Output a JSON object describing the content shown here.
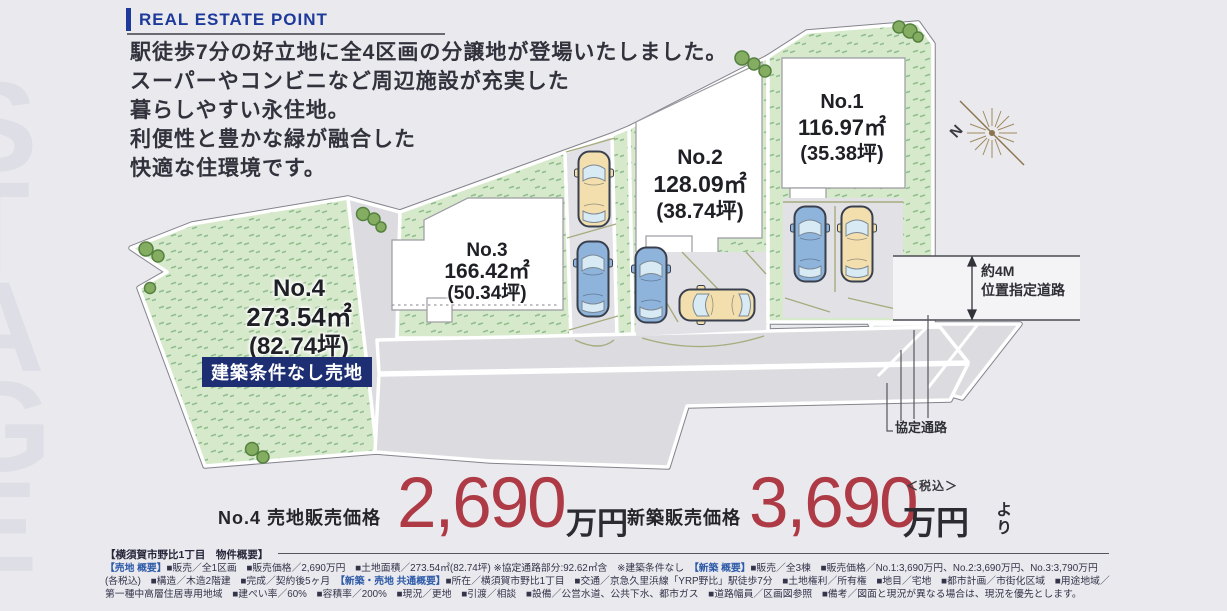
{
  "header": {
    "title": "REAL ESTATE POINT"
  },
  "intro": {
    "line1": "駅徒歩7分の好立地に全4区画の分譲地が登場いたしました。",
    "line2": "スーパーやコンビニなど周辺施設が充実した",
    "line3": "暮らしやすい永住地。",
    "line4": "利便性と豊かな緑が融合した",
    "line5": "快適な住環境です。"
  },
  "watermark": {
    "letters": "STAGE"
  },
  "plots": [
    {
      "id": "No.1",
      "area_sqm": "116.97㎡",
      "area_tsubo": "(35.38坪)"
    },
    {
      "id": "No.2",
      "area_sqm": "128.09㎡",
      "area_tsubo": "(38.74坪)"
    },
    {
      "id": "No.3",
      "area_sqm": "166.42㎡",
      "area_tsubo": "(50.34坪)"
    },
    {
      "id": "No.4",
      "area_sqm": "273.54㎡",
      "area_tsubo": "(82.74坪)",
      "badge": "建築条件なし売地"
    }
  ],
  "map_labels": {
    "road_width": "約4M",
    "road_type": "位置指定道路",
    "passage": "協定通路",
    "compass_north": "N"
  },
  "prices": {
    "land": {
      "label": "No.4 売地販売価格",
      "amount": "2,690",
      "unit": "万円"
    },
    "new_build": {
      "label": "新築販売価格",
      "amount": "3,690",
      "unit": "万円",
      "tax_note": "＜税込＞",
      "suffix": "より"
    }
  },
  "outline": {
    "title": "【横須賀市野比1丁目　物件概要】",
    "line1": [
      {
        "t": "【売地 概要】",
        "c": "blue"
      },
      {
        "t": "■販売／全1区画　■販売価格／2,690万円　■土地面積／273.54㎡(82.74坪) ※協定通路部分:92.62㎡含　※建築条件なし　",
        "c": "n"
      },
      {
        "t": "【新築 概要】",
        "c": "blue"
      },
      {
        "t": "■販売／全3棟　■販売価格／No.1:3,690万円、No.2:3,690万円、No.3:3,790万円",
        "c": "n"
      }
    ],
    "line2": [
      {
        "t": "(各税込)　■構造／木造2階建　■完成／契約後5ヶ月　",
        "c": "n"
      },
      {
        "t": "【新築・売地 共通概要】",
        "c": "blue"
      },
      {
        "t": "■所在／横須賀市野比1丁目　■交通／京急久里浜線「YRP野比」駅徒歩7分　■土地権利／所有権　■地目／宅地　■都市計画／市街化区域　■用途地域／",
        "c": "n"
      }
    ],
    "line3": [
      {
        "t": "第一種中高層住居専用地域　■建ぺい率／60%　■容積率／200%　■現況／更地　■引渡／相談　■設備／公営水道、公共下水、都市ガス　■道路幅員／区画図参照　■備考／図面と現況が異なる場合は、現況を優先とします。",
        "c": "n"
      }
    ]
  },
  "colors": {
    "accent_navy": "#1d3a9a",
    "badge_navy": "#1d2f72",
    "price_red": "#ad3a44",
    "grass_green": "#d7e9cb",
    "road_gray": "#dcdce0",
    "page_bg": "#e9e9ee"
  }
}
